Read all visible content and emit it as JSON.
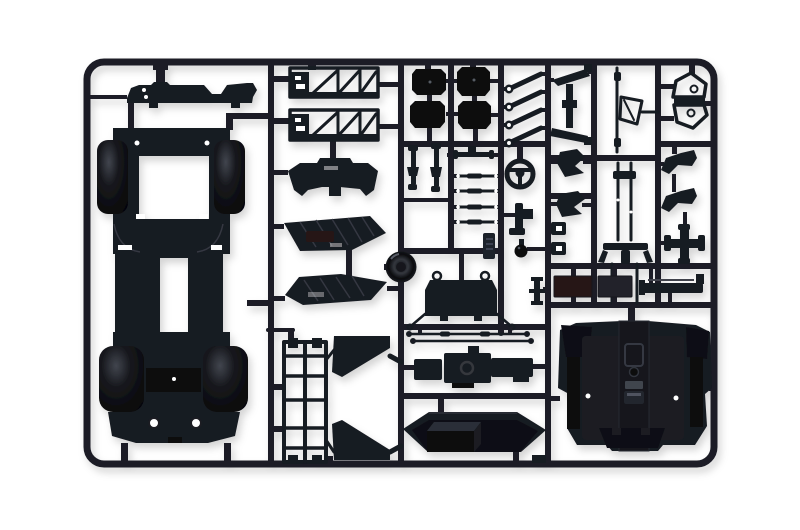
{
  "image": {
    "type": "photograph",
    "subject": "Black injection-molded plastic model kit sprue (parts tree) with car model components, photographed on a white background"
  },
  "colors": {
    "background": "#ffffff",
    "runner": "#1b1e27",
    "sprue": "#181a21",
    "deep": "#0b0c10",
    "edge": "#343842",
    "floor": "#1b1e24",
    "tunnel": "#12141a",
    "wall": "#0b0d10",
    "maroon": "#261316",
    "charcoal": "#20242b",
    "glint": "#5a5f6a"
  },
  "parts": {
    "frame": "rectangular sprue frame runner with rounded corners",
    "firewall": "flat firewall bulkhead panel",
    "chassis": "chassis floor pan with four glossy wheel-arch pods",
    "truss1": "ladder side-frame truss (upper)",
    "truss2": "ladder side-frame truss (lower)",
    "dashboard": "dashboard cowl panel",
    "panel_a": "ribbed underbody panel (upper)",
    "panel_b": "ribbed underbody panel (lower)",
    "dome": "round air-cleaner dome on runner junction",
    "boxes": "four rectangular equipment boxes",
    "shocks": "two coil-over shock absorbers",
    "t_part": "small T-shaped fitting",
    "tie_rods": "four steering tie rods with ball ends",
    "steering_wheel": "three-spoke steering wheel",
    "susp_arms": "four diagonal suspension link arms",
    "bracket_l": "L-shaped pedal bracket",
    "knob": "round gear knob",
    "tag": "molded part-number tag (text not legible)",
    "radiator": "radiator core with thin wire mounting frame and loops",
    "pulley": "small flanged pulley stack",
    "linkage_rods": "two long thin linkage rods",
    "engine": "engine and transmission assembly",
    "subframe": "rear subframe ladder with triangular gussets",
    "tank_cover": "roof-shaped tank cover panel with box",
    "tub": "interior floor tub with centre console tunnel",
    "arm_set": "Z-linked control arm pair",
    "pedal_a": "pedal arm part (upper)",
    "pedal_b": "pedal arm part (lower)",
    "clips": "two small clip parts",
    "rod_frame": "thin rod with jack-stand frame",
    "axle_forks": "twin shafts with forked axle ends",
    "wishbone": "towing-frame wishbone with curled hooks",
    "bracket_1": "mounting bracket (upper)",
    "bracket_2": "mounting bracket (lower)",
    "cross_part": "cross-shaped fitting",
    "sill": "side sill strip with end hook",
    "plate_maroon": "flat plate part (maroon tinted)",
    "plate_grey": "flat plate part (charcoal)"
  }
}
